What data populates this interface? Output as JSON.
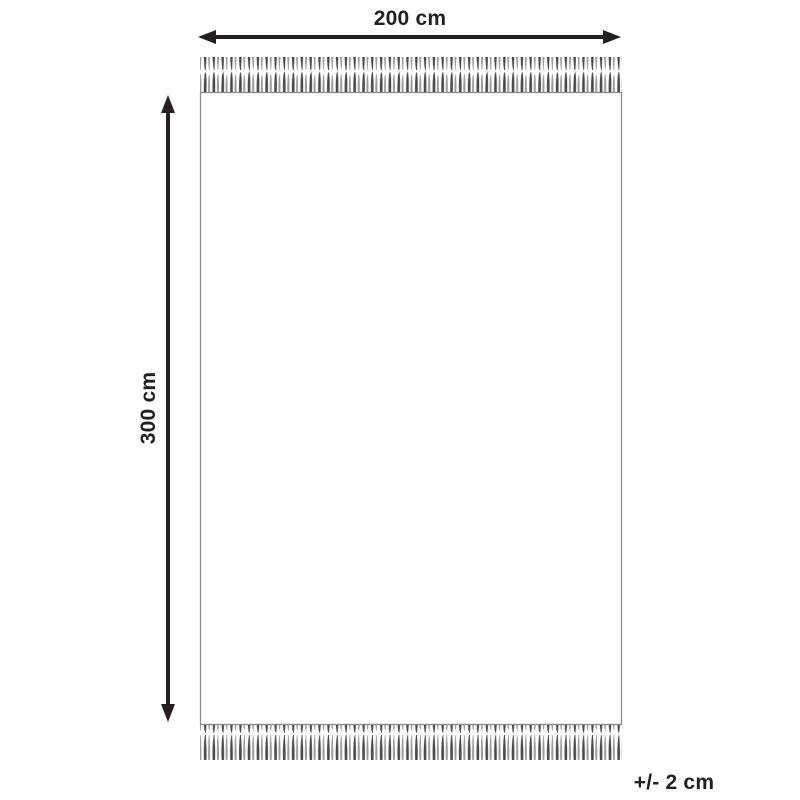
{
  "diagram": {
    "labels": {
      "width": "200 cm",
      "height": "300 cm",
      "tolerance": "+/- 2 cm"
    },
    "colors": {
      "arrow": "#231f20",
      "text": "#231f20",
      "rug_border": "#8c8c8c",
      "rug_fill": "#ffffff",
      "fringe_dark": "#4a4a4a",
      "fringe_light": "#9b9b9b",
      "background": "#ffffff"
    }
  }
}
